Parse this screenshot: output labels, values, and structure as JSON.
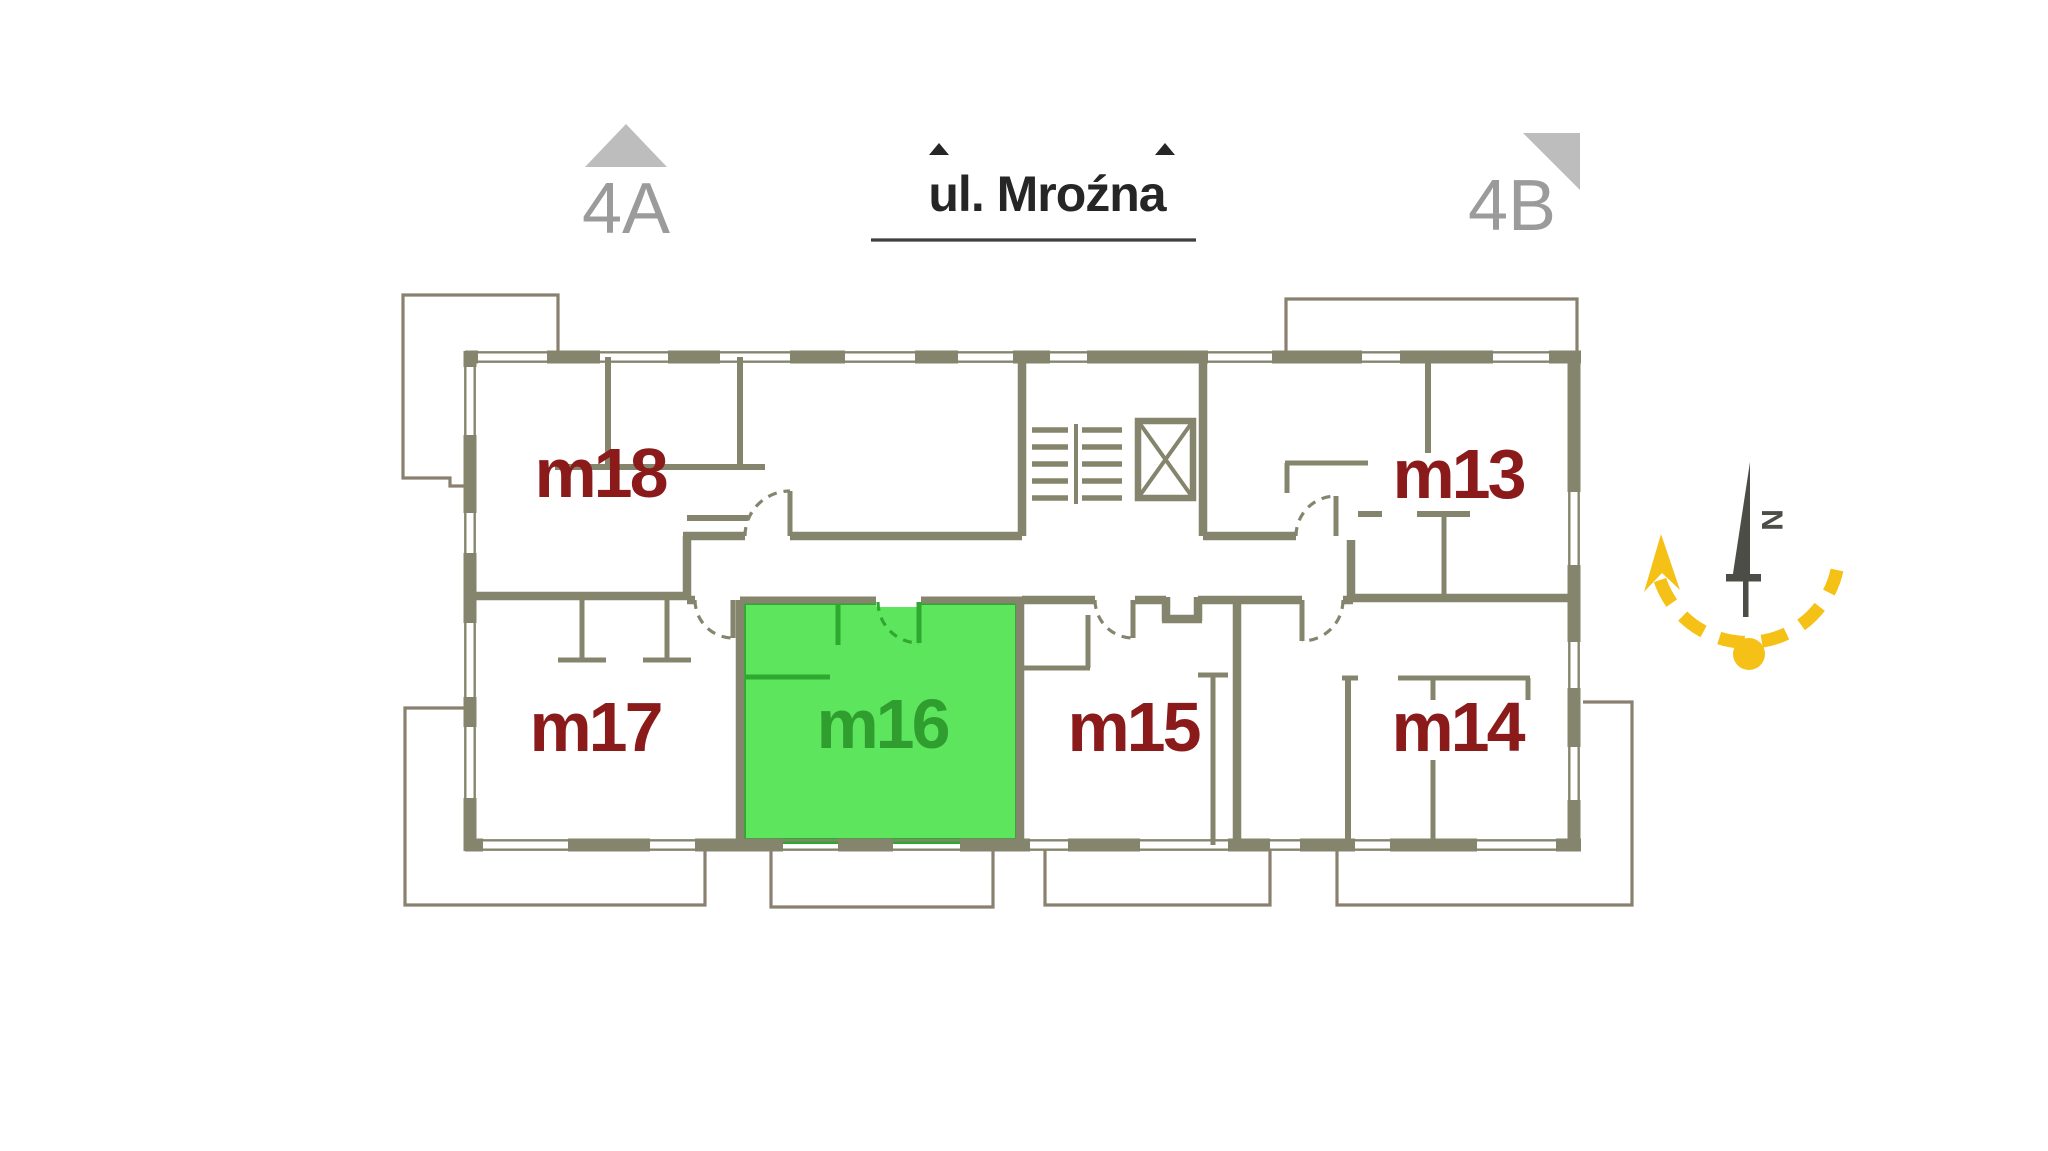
{
  "header": {
    "street": {
      "label": "ul. Mroźna"
    },
    "building_markers": [
      {
        "label": "4A"
      },
      {
        "label": "4B"
      }
    ]
  },
  "floorplan": {
    "units": [
      {
        "id": "m13",
        "label": "m13",
        "highlighted": false
      },
      {
        "id": "m14",
        "label": "m14",
        "highlighted": false
      },
      {
        "id": "m15",
        "label": "m15",
        "highlighted": false
      },
      {
        "id": "m16",
        "label": "m16",
        "highlighted": true
      },
      {
        "id": "m17",
        "label": "m17",
        "highlighted": false
      },
      {
        "id": "m18",
        "label": "m18",
        "highlighted": false
      }
    ],
    "highlighted_unit": "m16",
    "features": [
      "staircase",
      "elevator"
    ]
  },
  "compass": {
    "north_label": "N"
  },
  "colors": {
    "page-bg": "#ffffff",
    "wall": "#85856D",
    "balcony": "#8A8070",
    "room-green": "#5DE55D",
    "room-green-border": "#2EA82E",
    "label-green": "#2F9E2F",
    "label-red": "#8B1B1B",
    "gray-text": "#9B9B9B",
    "gray-tri": "#BDBDBD",
    "street-text": "#262626",
    "underline": "#3F3F3F",
    "needle": "#4D4D47",
    "sun": "#F5C117"
  }
}
